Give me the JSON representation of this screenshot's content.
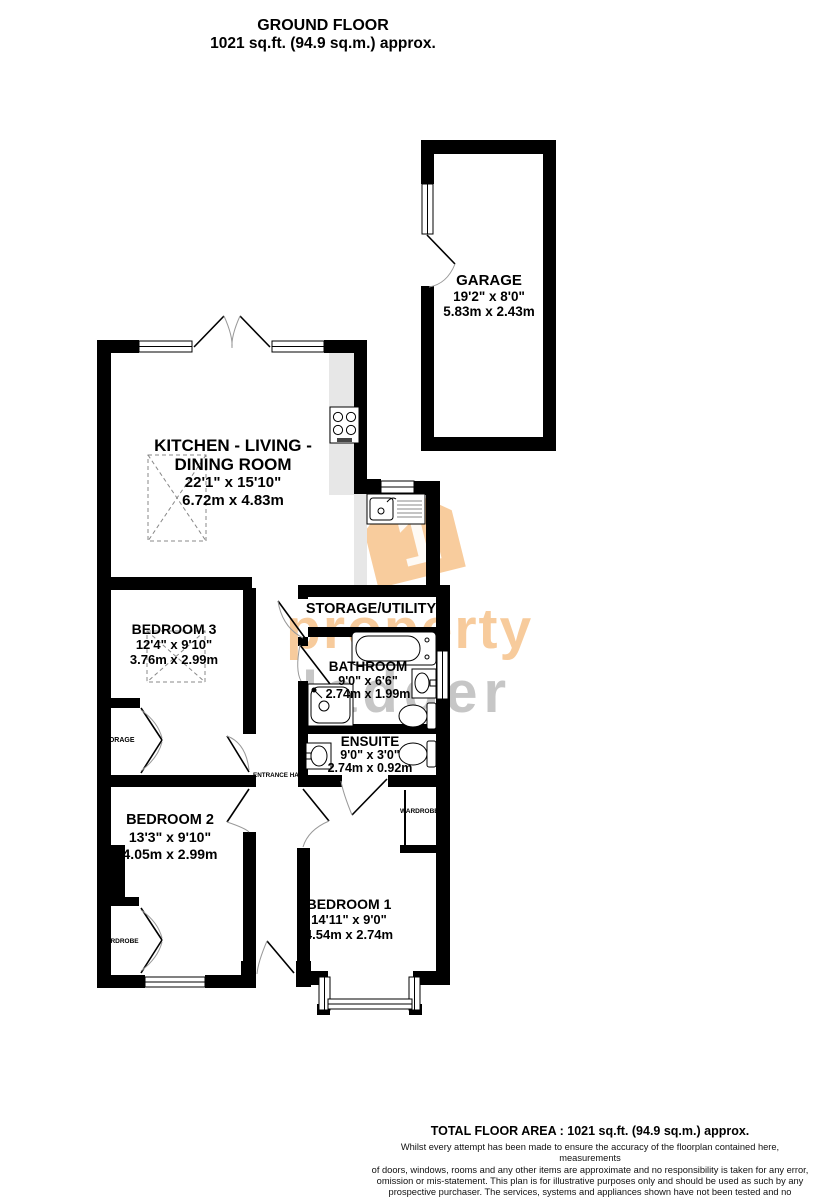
{
  "header": {
    "title": "GROUND FLOOR",
    "subtitle": "1021 sq.ft. (94.9 sq.m.) approx."
  },
  "rooms": {
    "garage": {
      "name": "GARAGE",
      "imperial": "19'2\" x 8'0\"",
      "metric": "5.83m x 2.43m"
    },
    "kitchen": {
      "name_line1": "KITCHEN - LIVING -",
      "name_line2": "DINING ROOM",
      "imperial": "22'1\" x 15'10\"",
      "metric": "6.72m x 4.83m"
    },
    "bedroom3": {
      "name": "BEDROOM 3",
      "imperial": "12'4\" x 9'10\"",
      "metric": "3.76m x 2.99m"
    },
    "storage_utility": {
      "name": "STORAGE/UTILITY"
    },
    "bathroom": {
      "name": "BATHROOM",
      "imperial": "9'0\" x 6'6\"",
      "metric": "2.74m x 1.99m"
    },
    "ensuite": {
      "name": "ENSUITE",
      "imperial": "9'0\" x 3'0\"",
      "metric": "2.74m x 0.92m"
    },
    "bedroom2": {
      "name": "BEDROOM 2",
      "imperial": "13'3\" x 9'10\"",
      "metric": "4.05m x 2.99m"
    },
    "bedroom1": {
      "name": "BEDROOM 1",
      "imperial": "14'11\" x 9'0\"",
      "metric": "4.54m x 2.74m"
    },
    "storage": {
      "name": "STORAGE"
    },
    "entrance_hall": {
      "name": "ENTRANCE HALL"
    },
    "wardrobe_bed2": {
      "name": "WARDROBE"
    },
    "wardrobe_bed1": {
      "name": "WARDROBE"
    }
  },
  "watermark": {
    "word1": "property",
    "word2": "ladder",
    "logo_digit": "1",
    "orange": "#F2A24C",
    "gray": "#8E8E8E"
  },
  "footer": {
    "total": "TOTAL FLOOR AREA : 1021 sq.ft. (94.9 sq.m.) approx.",
    "disclaimer_lines": [
      "Whilst every attempt has been made to ensure the accuracy of the floorplan contained here, measurements",
      "of doors, windows, rooms and any other items are approximate and no responsibility is taken for any error,",
      "omission or mis-statement. This plan is for illustrative purposes only and should be used as such by any",
      "prospective purchaser. The services, systems and appliances shown have not been tested and no guarantee",
      "as to their operability or efficiency can be given."
    ],
    "credit": "Made with Metropix ©2025"
  }
}
